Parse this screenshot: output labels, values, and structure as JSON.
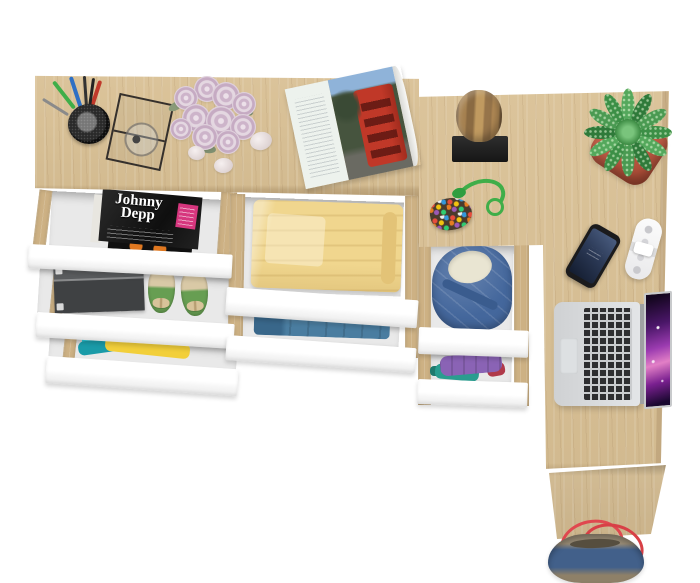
{
  "scene": {
    "background_color": "#ffffff",
    "subject": "l-shaped-oak-desk-with-open-drawers-top-view"
  },
  "palette": {
    "oak": "#d9c094",
    "oak_rail": "#cdb184",
    "drawer_front_white": "#ffffff",
    "drawer_interior_gray": "#e9e9e9",
    "blanket_yellow": "#f0d68e",
    "denim_jacket_blue": "#44679c",
    "folded_shirt_blue": "#4a7da0",
    "plant_pot_red": "#b0503c",
    "plant_green": "#4a9a52",
    "bag_denim_blue": "#42608a",
    "bag_handle_red": "#e0484f",
    "laptop_silver": "#d5d7d9",
    "laptop_screen_purple": "#9b3bb0",
    "rose_pink": "#cdb4ca",
    "magazine_badge_pink": "#d6367e"
  },
  "magazine_cover": {
    "title_line1": "Johnny",
    "title_line2": "Depp"
  },
  "items": {
    "drawers_left_unit": [
      "magazines",
      "shoebox-and-green-ballet-flats",
      "colorful-folded-clothes"
    ],
    "drawers_middle_unit": [
      "folded-yellow-blanket",
      "folded-blue-shirt"
    ],
    "drawers_right_unit": [
      "denim-jacket",
      "purple-and-teal-clothes"
    ],
    "desk_props": [
      "pen-cup",
      "wire-mesh-tray",
      "rose-bouquet",
      "pebbles",
      "open-magazine",
      "log-sculpture",
      "succulent-plant",
      "bead-keychain",
      "smartphone",
      "cable-organizer",
      "laptop",
      "denim-tote-bag"
    ]
  }
}
